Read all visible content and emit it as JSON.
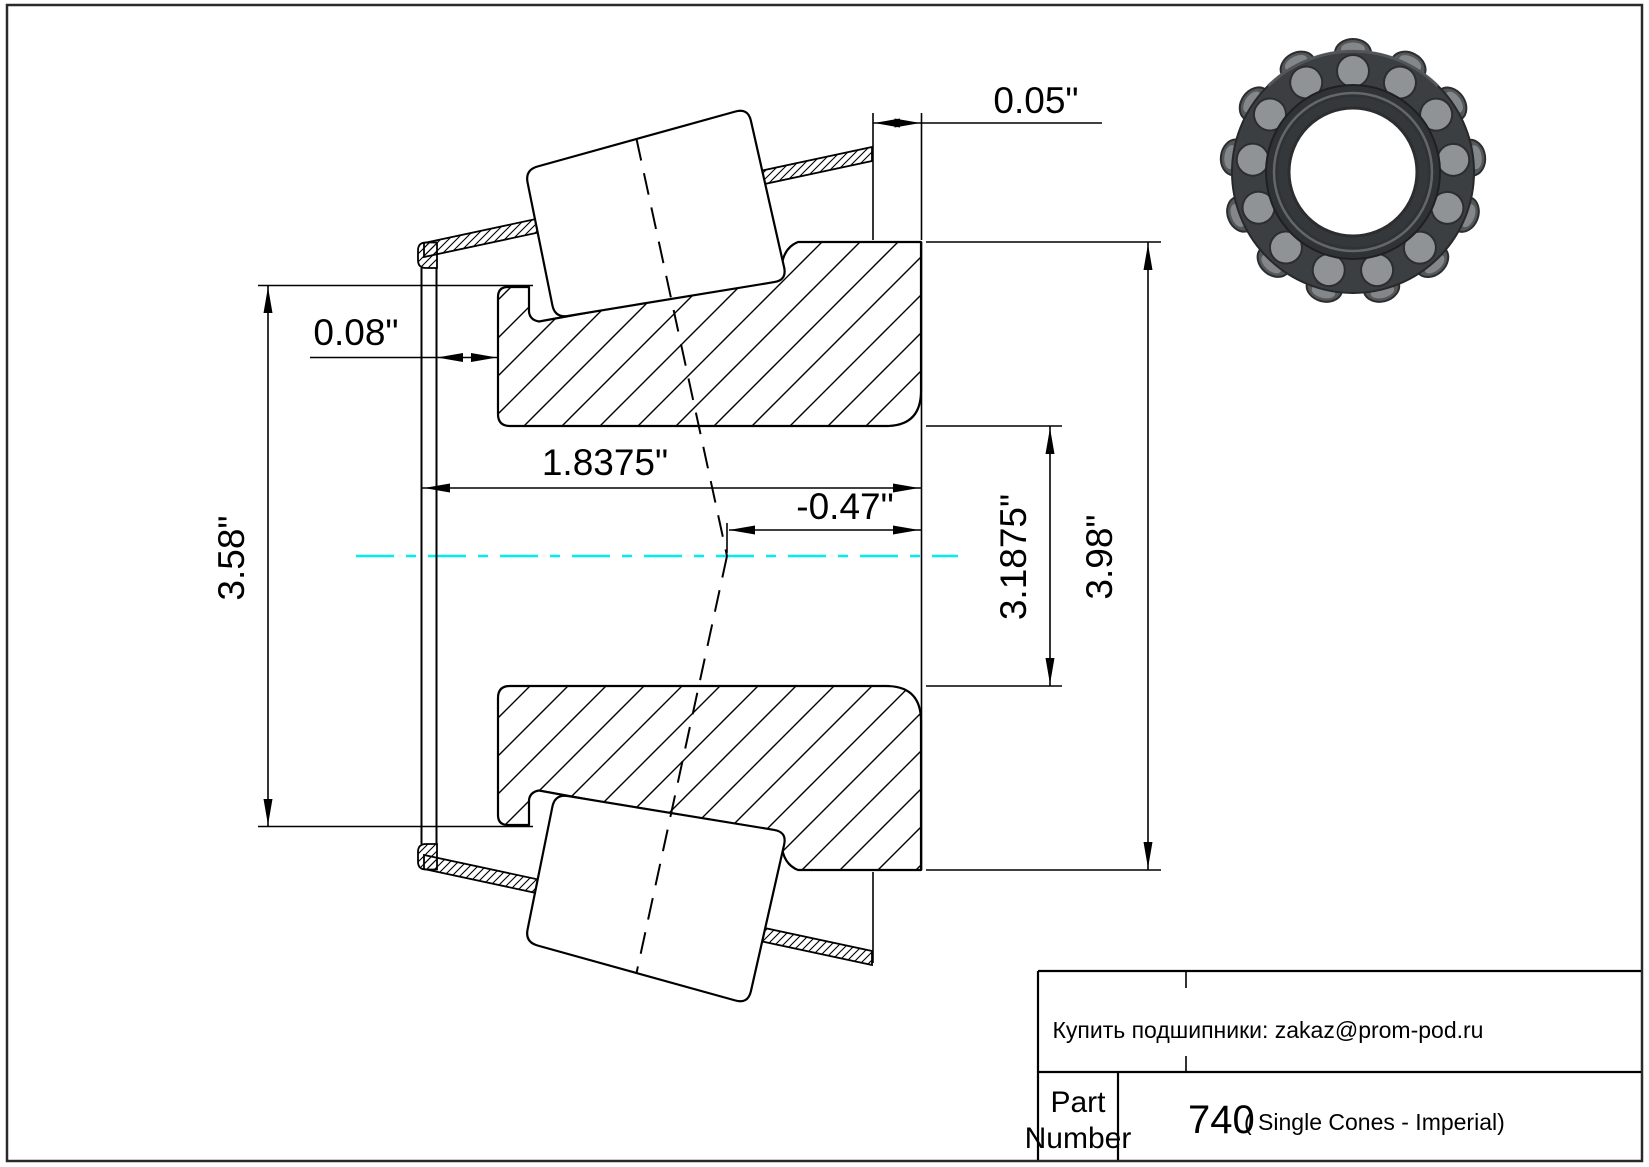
{
  "colors": {
    "line": "#000000",
    "centerline": "#00ececec",
    "centerline_hex": "#00eeee",
    "border": "#2a2a2a",
    "bearing_ring": "#3c3f42",
    "bearing_roller": "#8f9396"
  },
  "drawing": {
    "dims": {
      "back_gap": "0.05\"",
      "front_gap": "0.08\"",
      "cone_width": "1.8375\"",
      "effective_center": "-0.47\"",
      "bore_diameter": "3.1875\"",
      "cage_outer_diameter": "3.98\"",
      "front_flange_diameter": "3.58\""
    }
  },
  "title_block": {
    "contact_line": "Купить подшипники: zakaz@prom-pod.ru",
    "part_label_line1": "Part",
    "part_label_line2": "Number",
    "part_number": "740",
    "part_note": "( Single Cones - Imperial)"
  }
}
